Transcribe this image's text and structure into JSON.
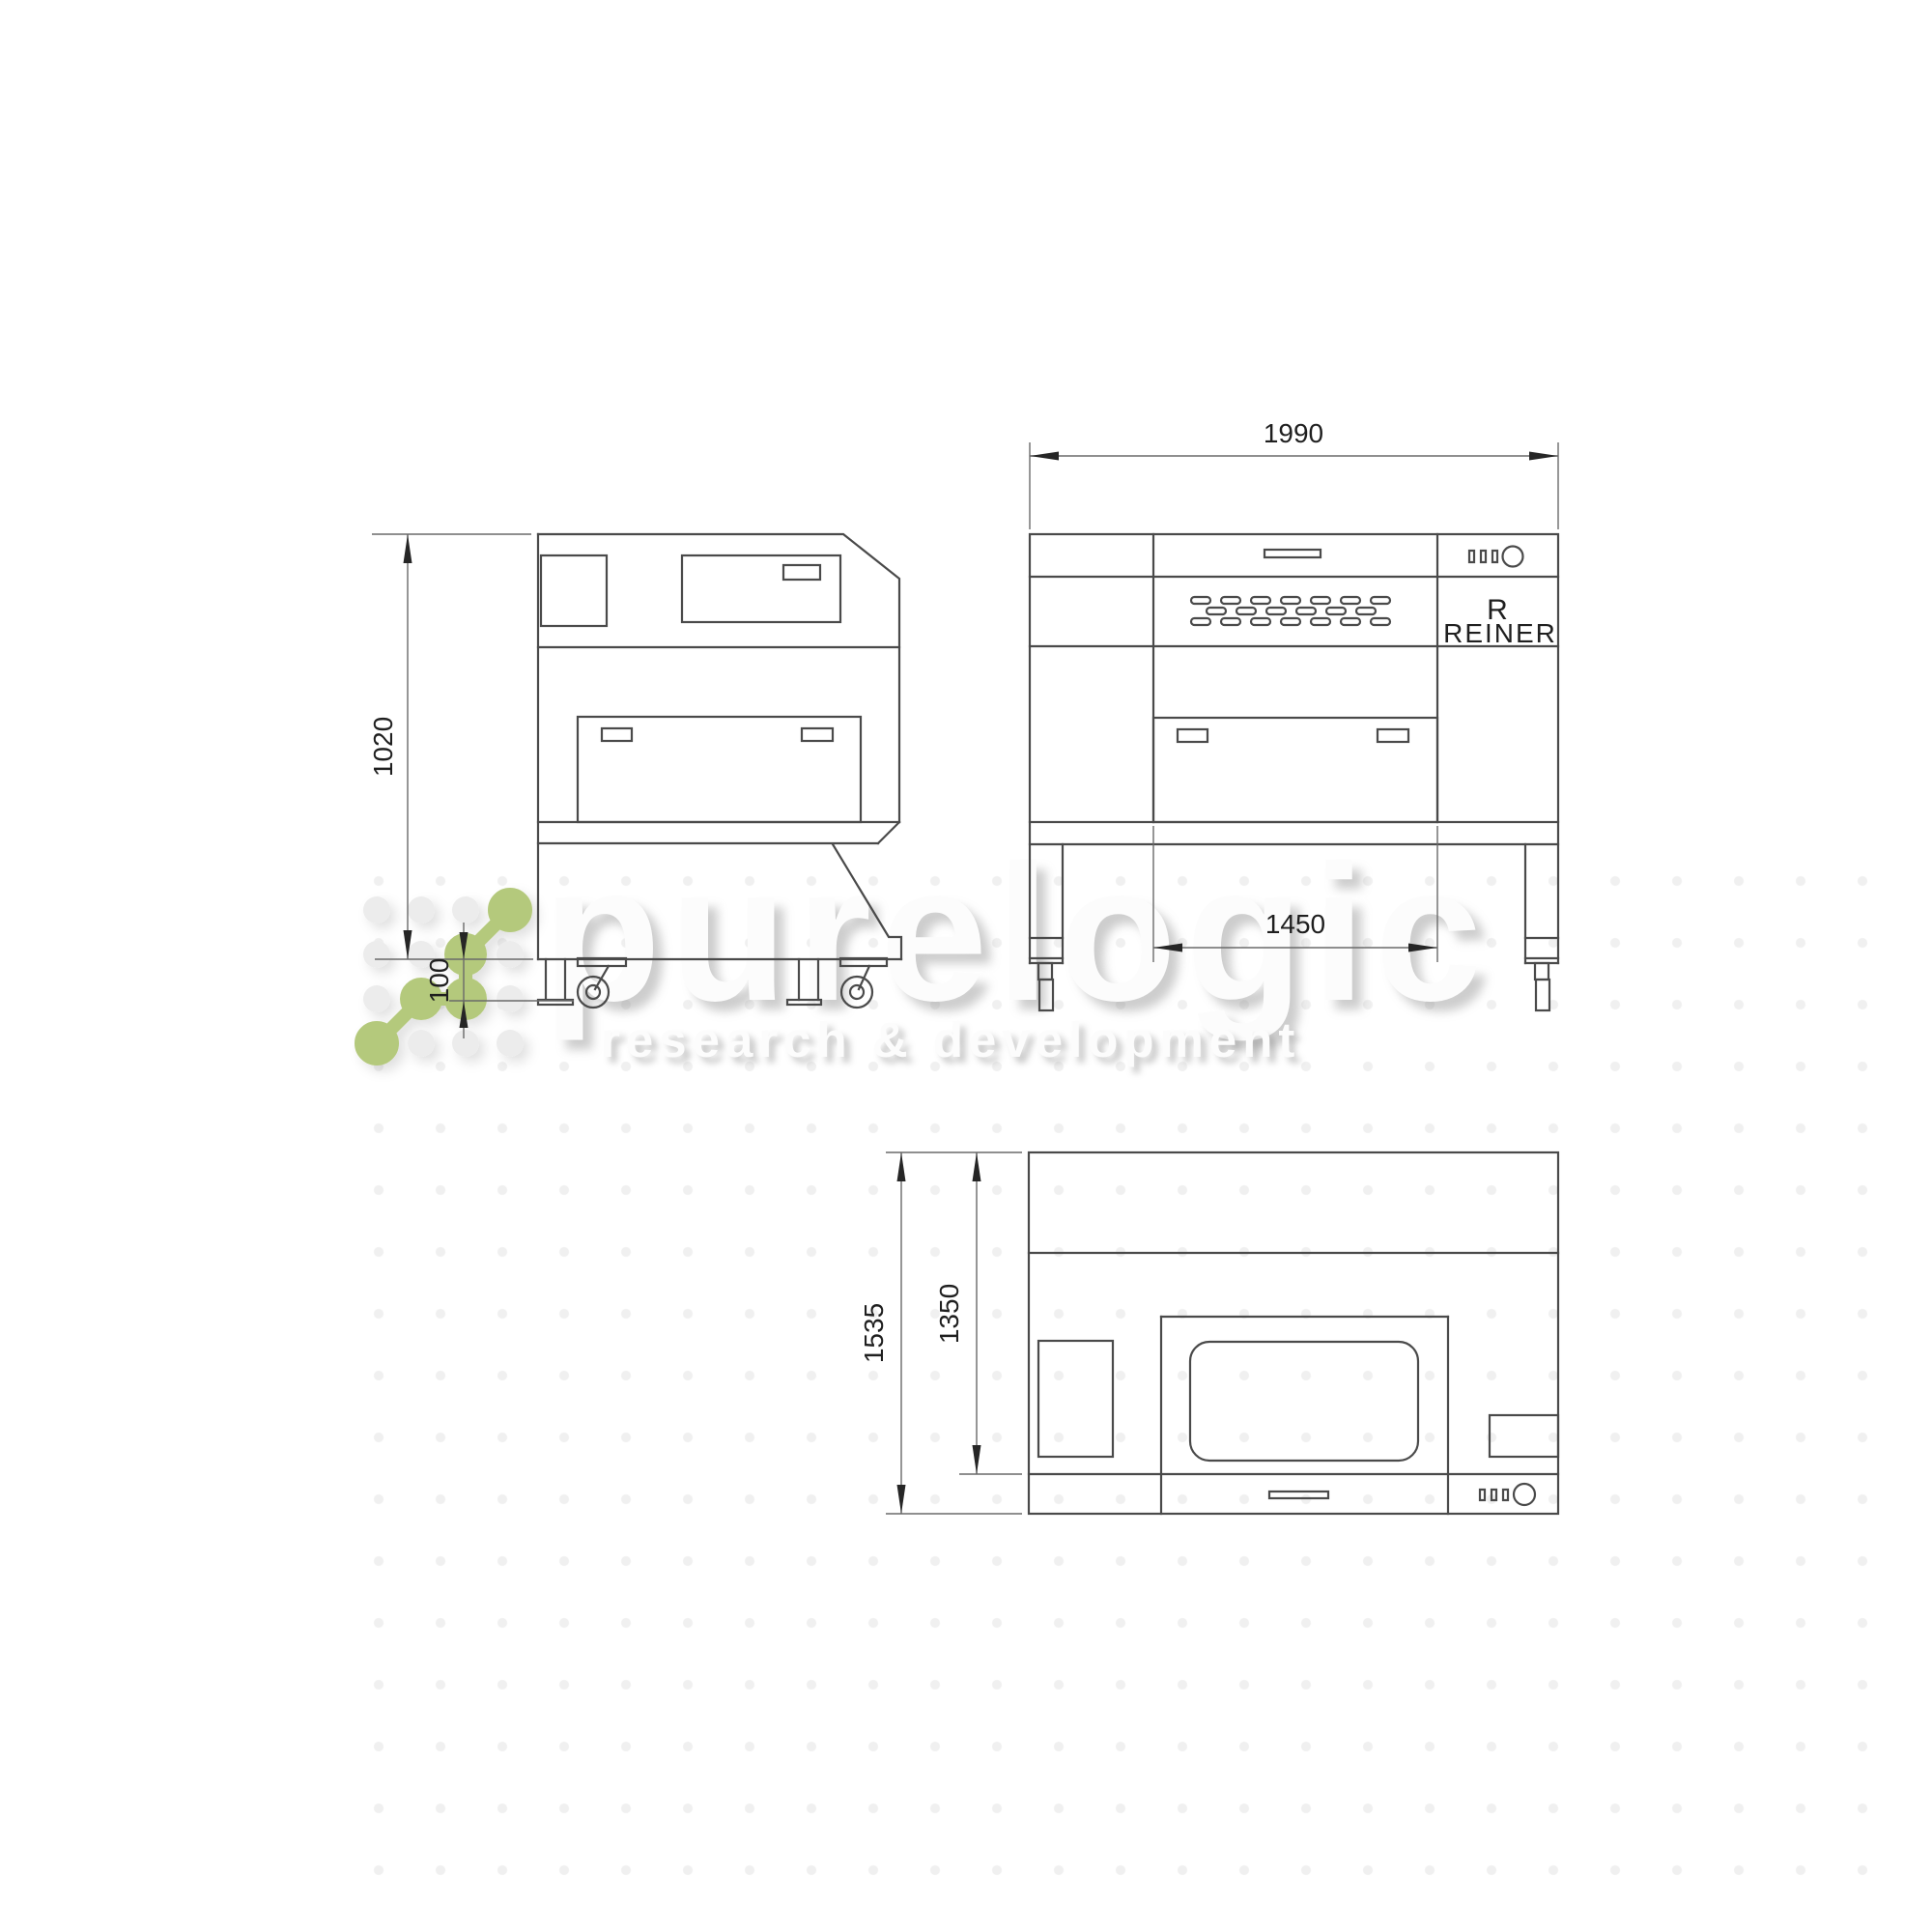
{
  "drawing": {
    "type": "three-view dimension drawing of a laser machine",
    "views": {
      "side": {
        "dimensions": {
          "height": "1020",
          "ground_clearance": "100"
        }
      },
      "front": {
        "dimensions": {
          "width": "1990",
          "door_width": "1450"
        },
        "brand_mark": "R",
        "brand_name": "REINER"
      },
      "top": {
        "dimensions": {
          "depth_total": "1535",
          "depth_body": "1350"
        }
      }
    }
  },
  "watermark": {
    "brand": "purelogic",
    "tagline": "research & development",
    "accent_green": "#b4c97b",
    "text_color": "#fcfcfc"
  },
  "colors": {
    "object_line": "#4a4a4a",
    "thin_line": "#6a6a6a",
    "dimension_text": "#1f1f1f",
    "background": "#ffffff"
  }
}
